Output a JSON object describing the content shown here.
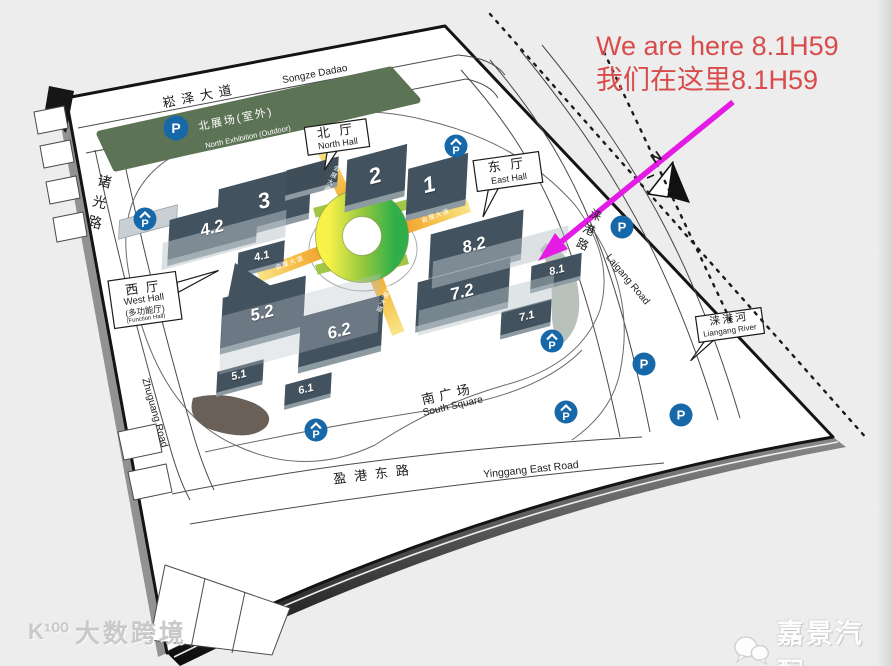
{
  "annotation": {
    "line1": "We are here 8.1H59",
    "line2": "我们在这里8.1H59"
  },
  "map": {
    "halls": {
      "h1": "1",
      "h2": "2",
      "h3": "3",
      "h41": "4.1",
      "h42": "4.2",
      "h51": "5.1",
      "h52": "5.2",
      "h61": "6.1",
      "h62": "6.2",
      "h71": "7.1",
      "h72": "7.2",
      "h81": "8.1",
      "h82": "8.2"
    },
    "callouts": {
      "north_hall": {
        "zh": "北 厅",
        "en": "North Hall"
      },
      "east_hall": {
        "zh": "东 厅",
        "en": "East Hall"
      },
      "west_hall": {
        "zh": "西 厅",
        "en": "West Hall",
        "sub_zh": "(多功能厅)",
        "sub_en": "(Function Hall)"
      },
      "river": {
        "zh": "涞港河",
        "en": "Liangang River"
      }
    },
    "roads": {
      "songze_zh": "崧泽大道",
      "songze_en": "Songze Dadao",
      "zhuguang_zh": "诸光路",
      "zhuguang_en": "Zhuguang Road",
      "yinggang_zh": "盈港东路",
      "yinggang_en": "Yinggang East Road",
      "laigang_zh": "涞港路",
      "laigang_en": "Laigang Road",
      "axis": "会展大道"
    },
    "areas": {
      "north_exhibition_zh": "北展场(室外)",
      "north_exhibition_en": "North Exhibition (Outdoor)",
      "south_square_zh": "南广场",
      "south_square_en": "South Square"
    },
    "compass": "N",
    "parking": "P"
  },
  "footer": {
    "watermark_logo": "K¹⁰⁰",
    "watermark": "大数跨境",
    "brand": "嘉景汽配"
  },
  "colors": {
    "annotation_red": "#d94c4c",
    "arrow_magenta": "#e41be4",
    "parking_blue": "#1668a8",
    "hall_dark": "#42525e",
    "lawn_green": "#5d7355",
    "ring_yellow": "#f7f148",
    "ring_green": "#2fae49",
    "axis_gold": "#f0a22e"
  }
}
